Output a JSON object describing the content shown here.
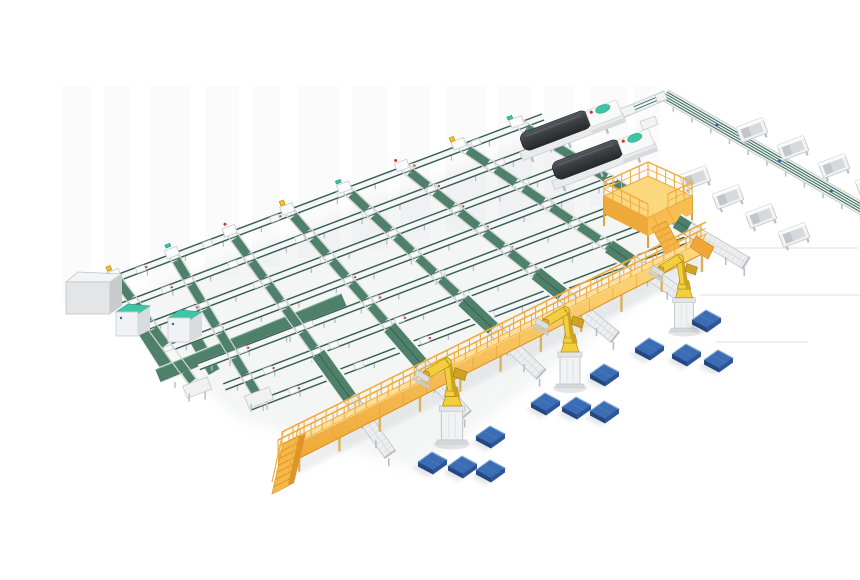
{
  "scene": {
    "title": "3D isometric render of an automated parcel sorting and robotic palletizing production line",
    "background_color": "#FFFFFF",
    "palette": {
      "beltGreen": "#4F8069",
      "beltGreenDark": "#35604F",
      "beltGreenLight": "#6FA38C",
      "tealAccent": "#3FC5A6",
      "frameWhite": "#F2F3F4",
      "frameLight": "#E6E8EA",
      "frameMid": "#C9CDD1",
      "frameDark": "#A8AEB4",
      "legGray": "#B9BEC4",
      "walkYellow": "#F5B94A",
      "walkYellowDark": "#E1982F",
      "walkYellowLight": "#FFE3A2",
      "railYellow": "#F2AC3E",
      "robotYellow": "#F2CF3D",
      "robotShade": "#CFA425",
      "palletBlue": "#3B6DB5",
      "palletBlueDark": "#24477F",
      "palletBlueMid": "#2D5597",
      "palletBlueLight": "#8FB0DC",
      "machineDark": "#3A3E42",
      "machineDarker": "#26292C",
      "cabinetGray": "#DFE1E3",
      "redDot": "#D2382C",
      "yellowTag": "#F2C12E",
      "blueDot": "#3D5FA8",
      "floorLine": "#E7E8EA",
      "shadow": "#9CA2A7"
    },
    "components": {
      "conveyor_grid": {
        "name": "main grid of belt conveyors",
        "row_count": 7,
        "cross_lane_count": 8,
        "belt_color_key": "beltGreen"
      },
      "incline_belts": {
        "name": "green incline belts feeding the walkway",
        "count": 6
      },
      "sorter_spur": {
        "name": "sortation spur conveyor (top right)",
        "chute_bin_count": 8
      },
      "packing_machines": {
        "name": "dark-hooded packing machines",
        "count": 2,
        "body_color_key": "machineDark"
      },
      "operator_platform": {
        "name": "yellow operator mezzanine with railing and stairs",
        "count": 1,
        "color_key": "walkYellow"
      },
      "elevated_walkway": {
        "name": "yellow elevated conveyor walkway with railings and end stairs",
        "count": 1,
        "color_key": "walkYellow"
      },
      "palletizing_robots": {
        "name": "yellow palletizing robot arms on pedestals",
        "count": 3,
        "color_key": "robotYellow"
      },
      "discharge_conveyors": {
        "name": "roller discharge conveyors under the walkway",
        "count": 6
      },
      "pallets": {
        "name": "blue floor pallets",
        "count": 12,
        "color_key": "palletBlue"
      },
      "return_loop": {
        "name": "green floor-level return loop conveyor (left)",
        "count": 1
      },
      "teal_cabinets": {
        "name": "white machines with teal tops",
        "count": 2
      },
      "control_cabinet": {
        "name": "gray control cabinet at line head",
        "count": 1
      },
      "lane_end_platforms": {
        "name": "lane end platforms",
        "count": 2
      },
      "floor_guide_lines": {
        "name": "faint floor lines (right)",
        "count": 3
      }
    }
  }
}
